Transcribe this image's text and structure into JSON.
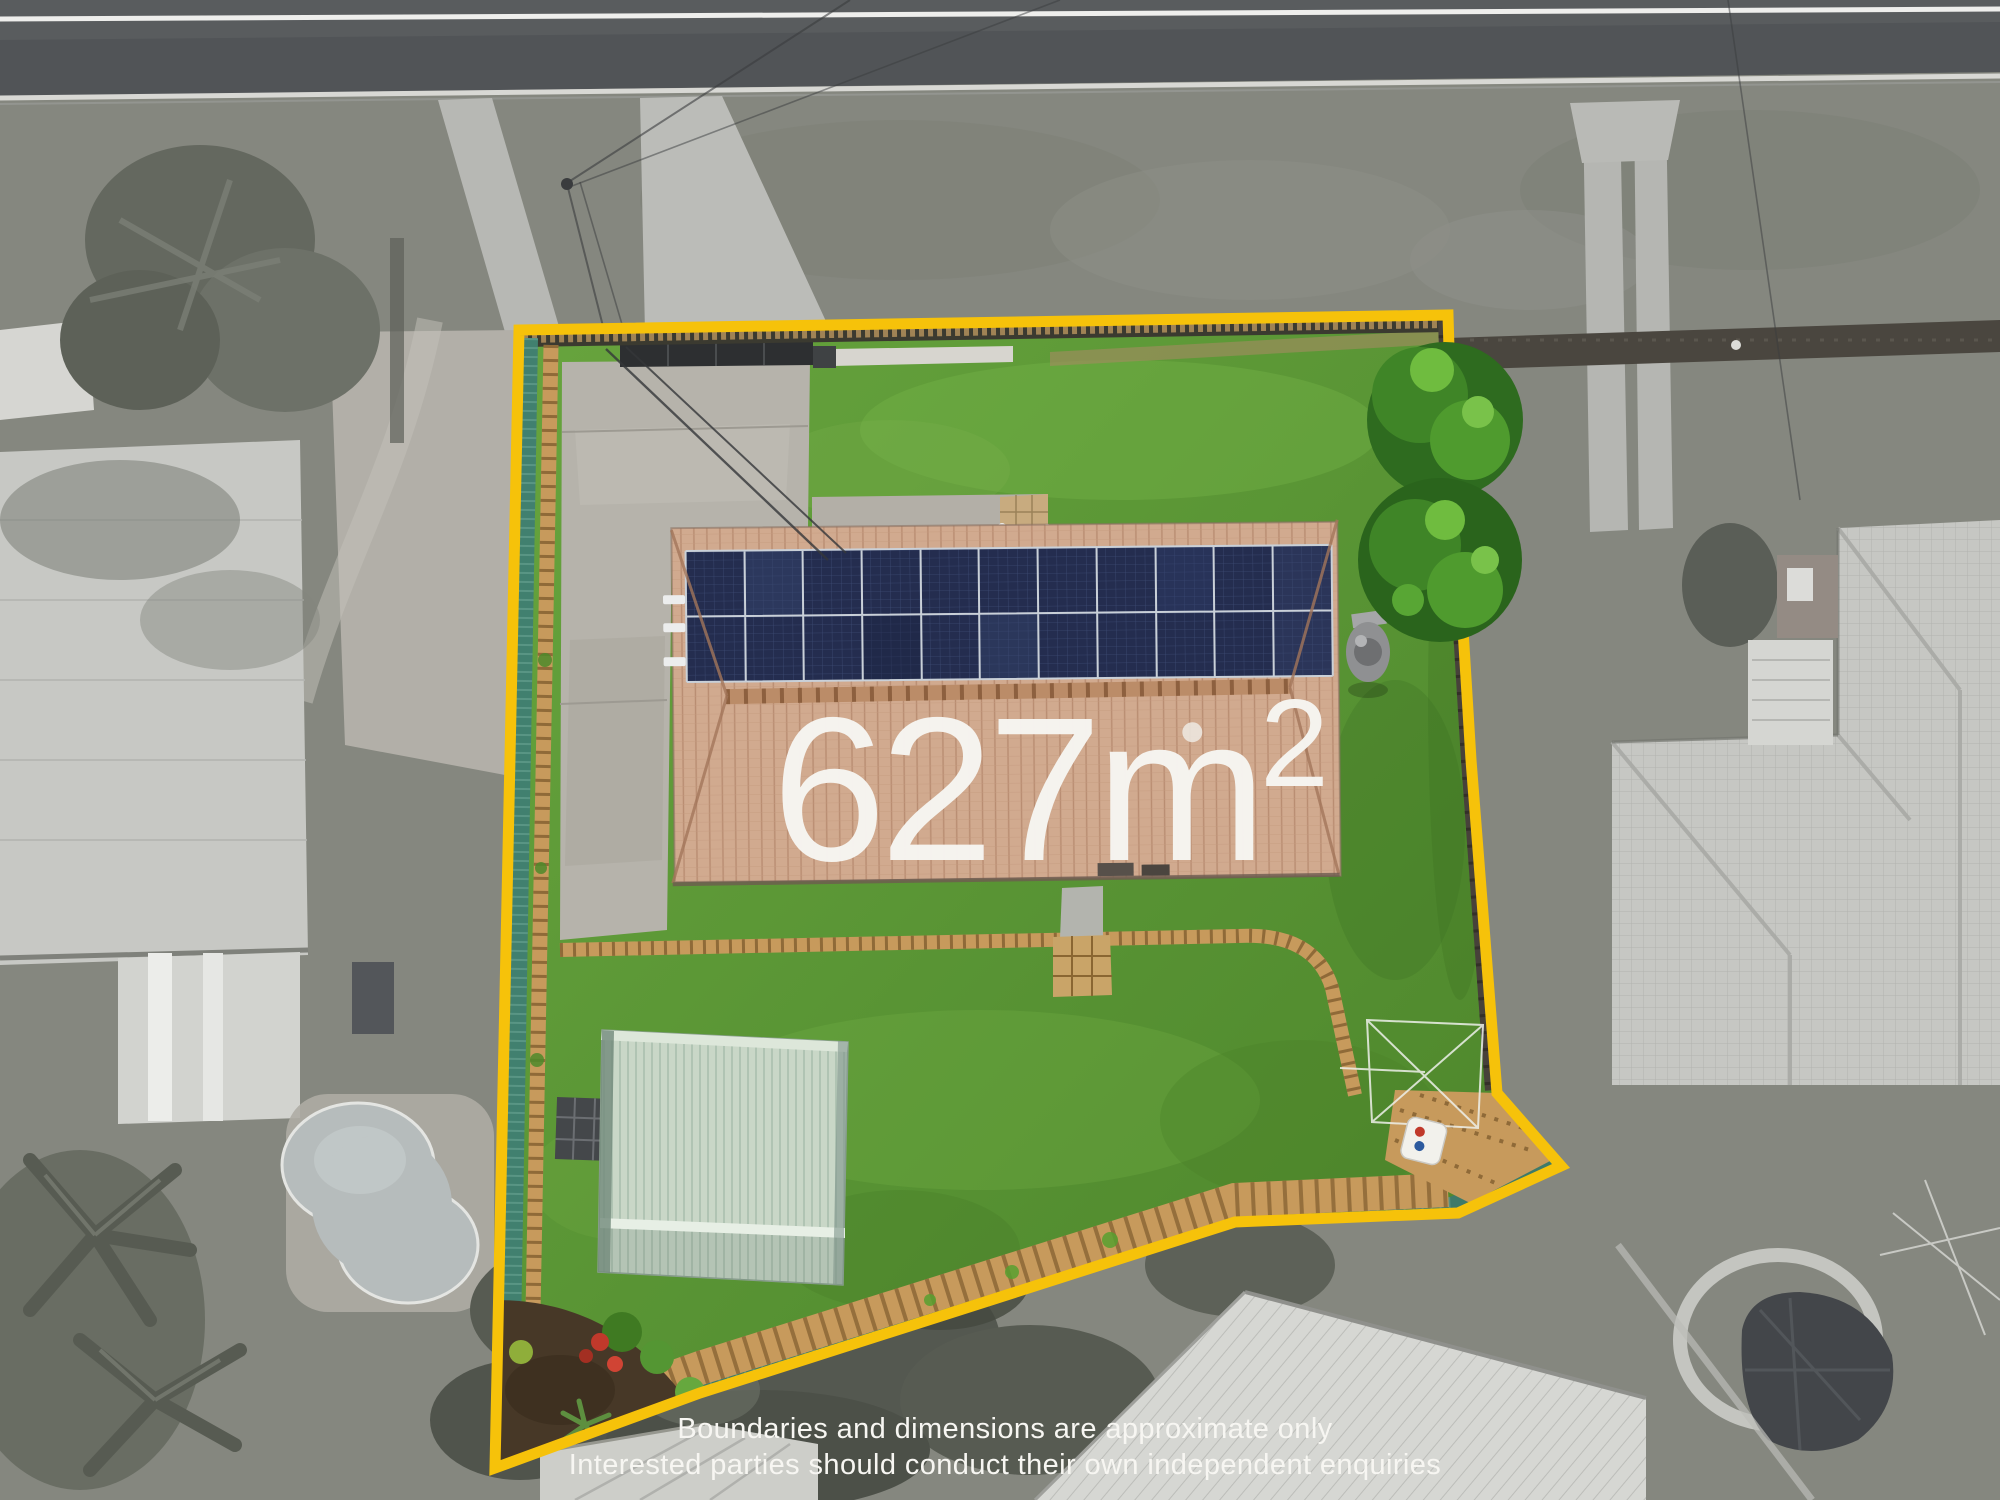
{
  "image": {
    "kind": "aerial-property-marketing-photo",
    "width_px": 2000,
    "height_px": 1500
  },
  "overlay": {
    "area_label": {
      "value": "627m",
      "superscript": "2"
    },
    "disclaimer": {
      "line1": "Boundaries and dimensions are approximate only",
      "line2": "Interested parties should conduct their own independent enquiries"
    }
  },
  "colors": {
    "boundary_yellow": "#F6C20A",
    "overlay_text_white": "#F7F6F2",
    "lawn_green": "#5A9335",
    "roof_terracotta": "#D1AA8F",
    "solar_panel_navy": "#242D4F",
    "fence_teal": "#41806F",
    "retaining_timber_tan": "#C79A5C",
    "shed_mint": "#C9D7C7",
    "concrete_grey": "#B6B3AB",
    "surroundings_grayscale": "#85877F"
  },
  "scene": {
    "features": [
      "property-boundary",
      "main-house-roof",
      "solar-panel-array",
      "garden-shed",
      "lawn",
      "concrete-driveway",
      "timber-retaining-walls",
      "teal-metal-fence",
      "timber-paling-fence",
      "ornamental-trees",
      "rotary-clothesline",
      "fence-sign",
      "neighbouring-houses",
      "street-road",
      "neighbour-swimming-pool",
      "palm-trees",
      "covered-boat",
      "power-lines"
    ]
  }
}
